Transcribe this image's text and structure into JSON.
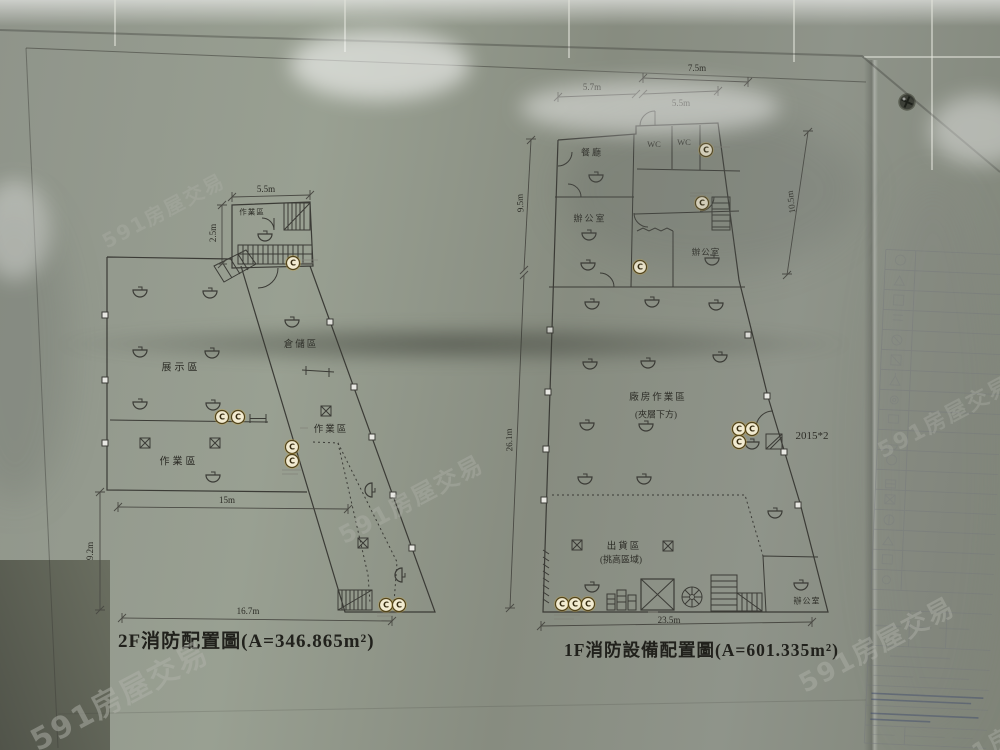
{
  "photo": {
    "watermark_text": "591房屋交易",
    "accent_colors": {
      "extinguisher_highlight": "#d5ad42",
      "paper": "#dededa",
      "wall": "#8f948a",
      "ink": "#3b3b36"
    }
  },
  "symbols": {
    "extinguisher_letter": "C"
  },
  "plans": {
    "f2": {
      "title": "2F消防配置圖(A=346.865m²)",
      "rooms": {
        "work_top": "作業區",
        "display": "展示區",
        "storage": "倉儲區",
        "work_corridor": "作業區",
        "work_bottom": "作業區"
      },
      "dims": {
        "top_width": "5.5m",
        "top_height": "2.5m",
        "mid_width": "15m",
        "left_height": "9.2m",
        "bottom_width": "16.7m"
      }
    },
    "f1": {
      "title": "1F消防設備配置圖(A=601.335m²)",
      "rooms": {
        "dining": "餐廳",
        "wc1": "WC",
        "wc2": "WC",
        "office_left": "辦公室",
        "office_mid": "辦公室",
        "factory_line1": "廠房作業區",
        "factory_line2": "(夾層下方)",
        "shipping_line1": "出貨區",
        "shipping_line2": "(挑高區域)",
        "office_bottom": "辦公室"
      },
      "dims": {
        "top_width": "7.5m",
        "top_left_width": "5.7m",
        "top_right_width": "5.5m",
        "upper_left_height": "9.5m",
        "upper_right_height": "10.5m",
        "full_left_height": "26.1m",
        "bottom_width": "23.5m"
      },
      "annotations": {
        "shutter_note": "2015*2"
      }
    }
  }
}
